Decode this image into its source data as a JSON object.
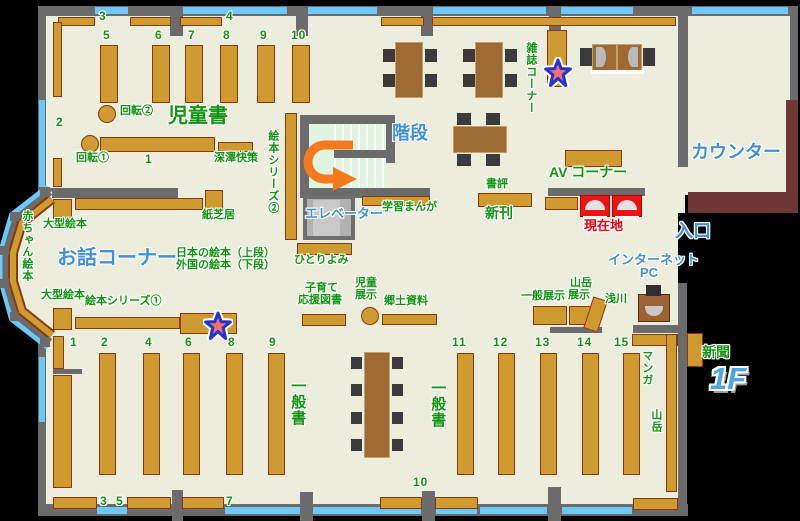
{
  "floor_tag": "1F",
  "palette": {
    "label_green": "#129412",
    "label_blue": "#4090d8",
    "label_red": "#e60012",
    "shelf_tan": "#cf9a30",
    "window_cyan": "#6cc9f7",
    "counter_maroon": "#6e3636",
    "floor_beige": "#eceddc",
    "wall_gray": "#6b6b6b",
    "arrow_orange": "#f5791d"
  },
  "icons": {
    "star": "star-marker",
    "uturn_arrow": "u-turn-arrow"
  },
  "labels": {
    "jidosho": "児童書",
    "kaiten1": "回転①",
    "kaiten2": "回転②",
    "fukazawa": "深澤快策",
    "kamishibai": "紙芝居",
    "ogata_ehon_1": "大型絵本",
    "ogata_ehon_2": "大型絵本",
    "akachan_ehon": "赤ちゃん絵本",
    "ohanashi_corner": "お話コーナー",
    "nihon_no_ehon": "日本の絵本（上段）",
    "gaikoku_no_ehon": "外国の絵本（下段）",
    "ehon_series1": "絵本シリーズ①",
    "ehon_series2": "絵本シリーズ②",
    "hitoriyomi": "ひとりよみ",
    "kaidan": "階段",
    "elevator": "エレベーター",
    "gakushu_manga": "学習まんが",
    "kosodate_1": "子育て",
    "kosodate_2": "応援図書",
    "jido_tenji_1": "児童",
    "jido_tenji_2": "展示",
    "kyodo_shiryo": "郷土資料",
    "shohyo": "書評",
    "shinkan": "新刊",
    "av_corner": "AV コーナー",
    "genzaichi": "現在地",
    "zasshi_corner": "雑誌コーナー",
    "counter": "カウンター",
    "iriguchi": "入口",
    "internet": "インターネット",
    "pc": "PC",
    "ippan_tenji": "一般展示",
    "sangaku_tenji_1": "山岳",
    "sangaku_tenji_2": "展示",
    "asakawa": "浅川",
    "ippansho_1": "一般書",
    "ippansho_2": "一般書",
    "manga": "マンガ",
    "sangaku": "山岳",
    "shimbun": "新聞",
    "floor_1f": "1F"
  },
  "numbers": {
    "top_wall": [
      "3",
      "4"
    ],
    "children_shelves": [
      "5",
      "6",
      "7",
      "8",
      "9",
      "10"
    ],
    "children_side": "2",
    "children_center_shelf": "1",
    "west_shelves": [
      "1",
      "2",
      "4",
      "6",
      "8",
      "9"
    ],
    "south_shelves": [
      "3",
      "5",
      "7"
    ],
    "south_center": "10",
    "east_shelves": [
      "11",
      "12",
      "13",
      "14",
      "15"
    ]
  }
}
